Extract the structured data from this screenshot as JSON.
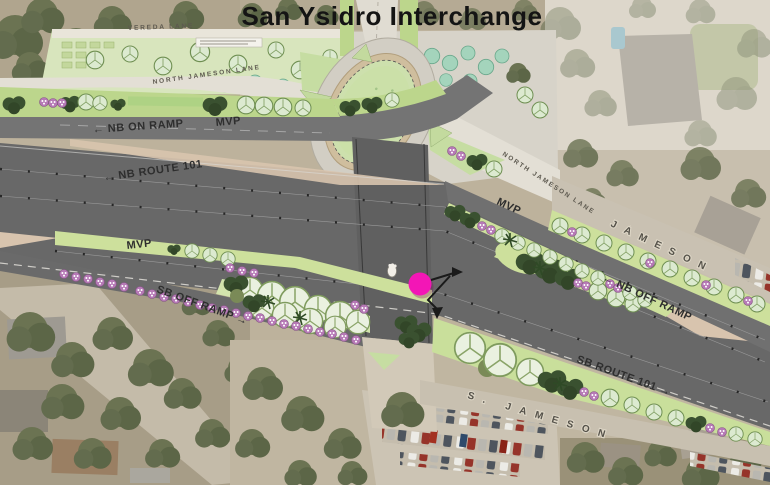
{
  "title": "San Ysidro Interchange",
  "labels": {
    "vereda_lane": "VEREDA LANE",
    "north_jameson_lane_west": "NORTH JAMESON LANE",
    "north_jameson_lane_east": "NORTH JAMESON LANE",
    "nb_on_ramp": "← NB ON RAMP",
    "nb_route_101": "← NB ROUTE 101",
    "nb_off_ramp": "← NB OFF RAMP",
    "sb_off_ramp": "SB OFF RAMP →",
    "sb_route_101": "SB ROUTE 101 →",
    "mvp": "MVP",
    "jameson_street": "JAMESON",
    "s_jameson_street": "S. JAMESON"
  },
  "marker": {
    "color": "#f316b6"
  },
  "colors": {
    "freeway_gray": "#686868",
    "plan_green": "#cde09c",
    "aerial_tan": "#bdb29c",
    "title_text": "#141414"
  }
}
